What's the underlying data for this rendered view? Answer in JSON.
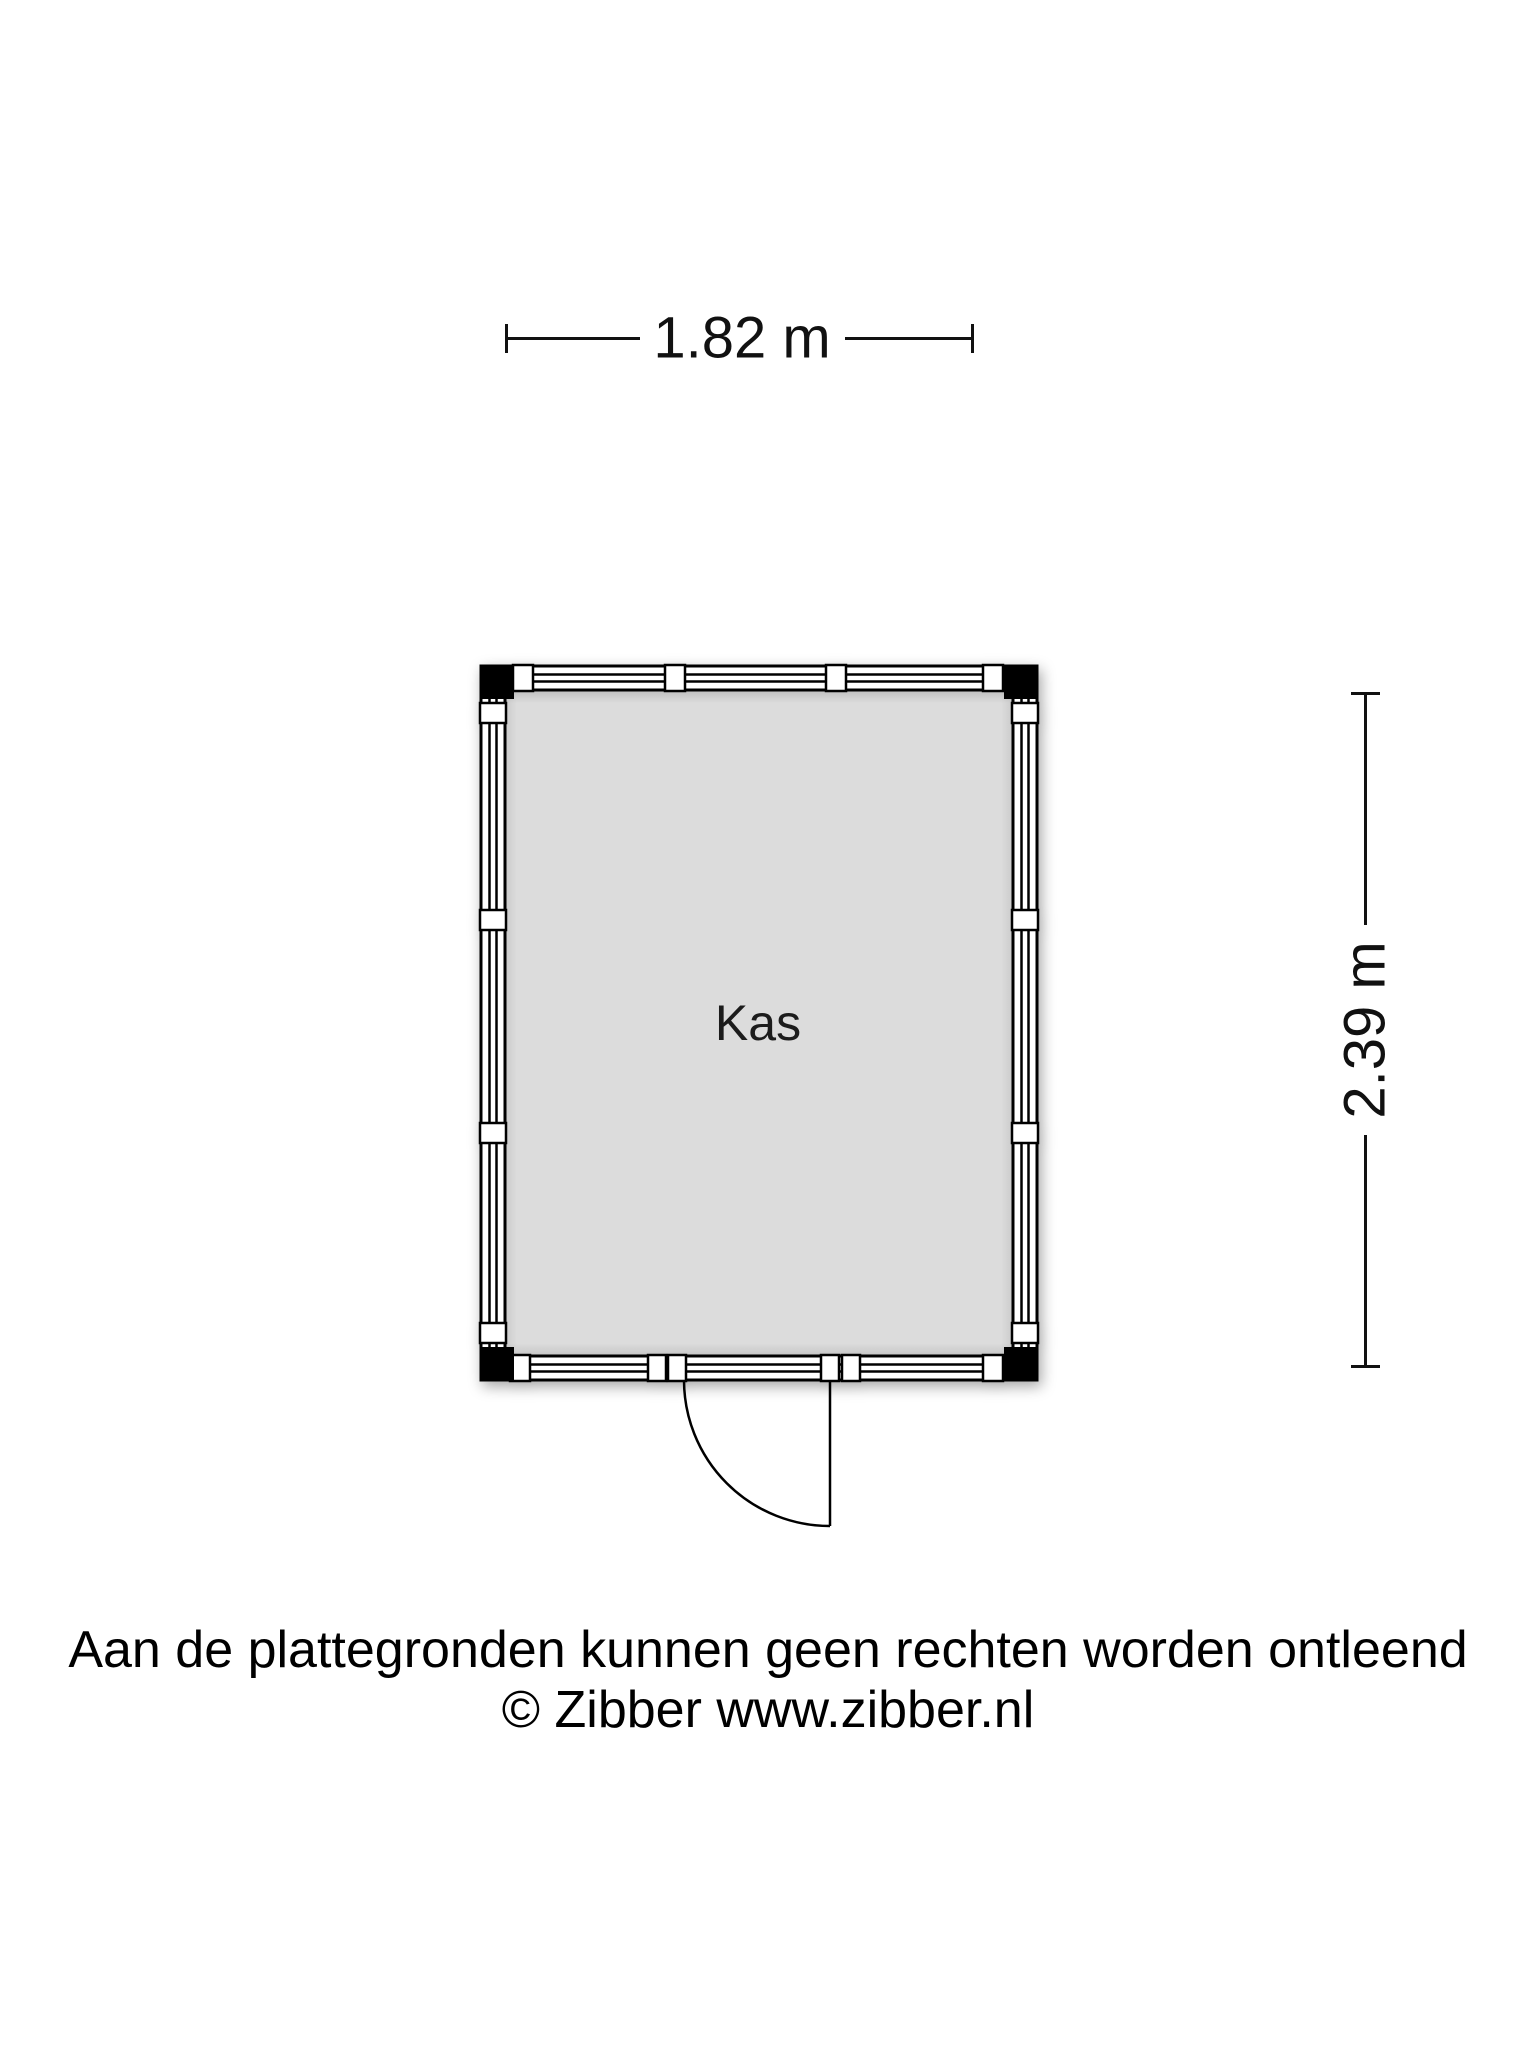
{
  "page": {
    "background": "#ffffff",
    "type_label": "floorplan"
  },
  "colors": {
    "line": "#000000",
    "wall_fill": "#ffffff",
    "room_fill": "#dcdcdc",
    "corner_post": "#000000",
    "text": "#111111"
  },
  "dimensions": {
    "width_label": "1.82 m",
    "height_label": "2.39 m"
  },
  "floorplan": {
    "room_label": "Kas"
  },
  "footer": {
    "disclaimer": "Aan de plattegronden kunnen geen rechten worden ontleend",
    "copyright": "© Zibber www.zibber.nl"
  }
}
